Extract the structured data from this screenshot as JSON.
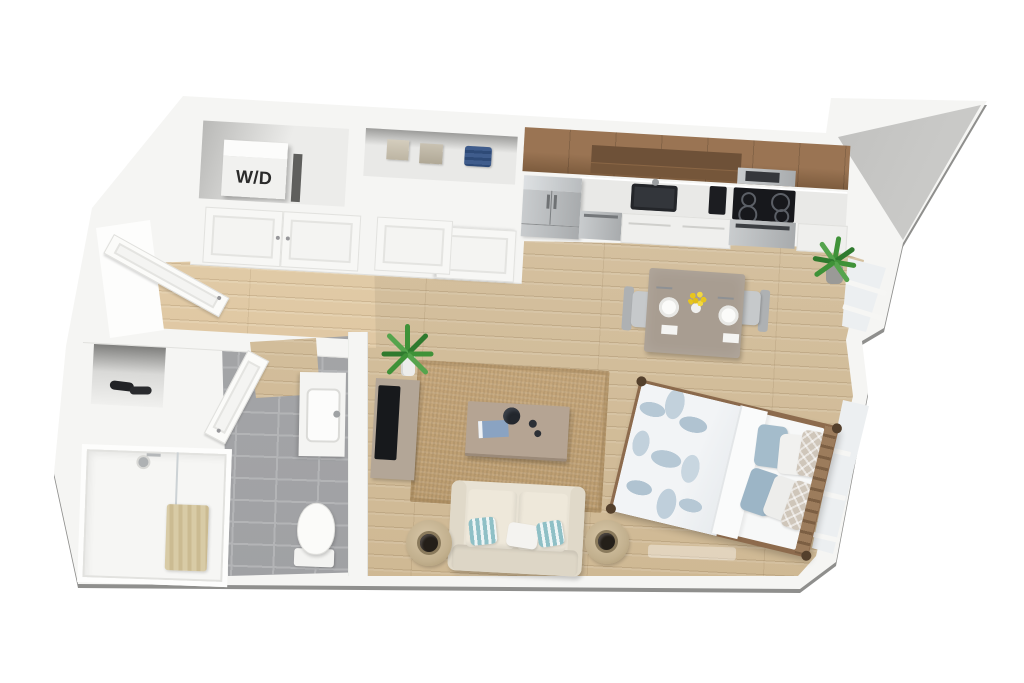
{
  "scene": {
    "title": "3D bird's-eye floor plan render of a studio apartment",
    "background": "#ffffff"
  },
  "labels": {
    "washer_dryer": "W/D"
  },
  "palette": {
    "wall": "#f5f5f3",
    "wall_edge": "#8f8f8d",
    "wood_floor": "#cdb690",
    "wood_floor_light": "#d8c5a6",
    "tile": "#9fa0a3",
    "tile_grout": "#b3b4b6",
    "cabinet_wood": "#9a7453",
    "cabinet_wood_dark": "#7d5c3e",
    "counter": "#e9e9e7",
    "stainless": "#a8abad",
    "appliance_black": "#17181c",
    "rug": "#c5a67a",
    "sofa_cream": "#e8e2d4",
    "pillow_teal": "#8fc0c6",
    "duvet_blue": "#b6c8d5",
    "bed_frame_wood": "#8d6b4d",
    "table_taupe": "#a89d91",
    "chair_gray": "#c6c9cb",
    "flower_yellow": "#e7c51e",
    "towel_tan": "#cbbb92",
    "plant": "#3f9238",
    "glass": "#eceff1"
  },
  "rooms": [
    {
      "id": "entry",
      "name": "entry"
    },
    {
      "id": "laundry-closet",
      "name": "laundry closet"
    },
    {
      "id": "linen-closet",
      "name": "closet"
    },
    {
      "id": "kitchen",
      "name": "kitchen"
    },
    {
      "id": "dining",
      "name": "dining area"
    },
    {
      "id": "living",
      "name": "living area"
    },
    {
      "id": "sleeping",
      "name": "sleeping area"
    },
    {
      "id": "bathroom",
      "name": "bathroom"
    }
  ],
  "furniture": [
    "washer-dryer",
    "storage-boxes",
    "folded-linens",
    "refrigerator",
    "dishwasher",
    "kitchen-sink",
    "coffee-maker",
    "range",
    "microwave",
    "dining-table",
    "dining-chairs",
    "place-settings",
    "flower-vase",
    "area-rug",
    "coffee-table",
    "loveseat-sofa",
    "ottoman-poufs",
    "tv-console",
    "tv",
    "potted-plants",
    "queen-bed",
    "bed-pillows",
    "shower",
    "towel",
    "vanity-sink",
    "toilet",
    "shoes"
  ]
}
